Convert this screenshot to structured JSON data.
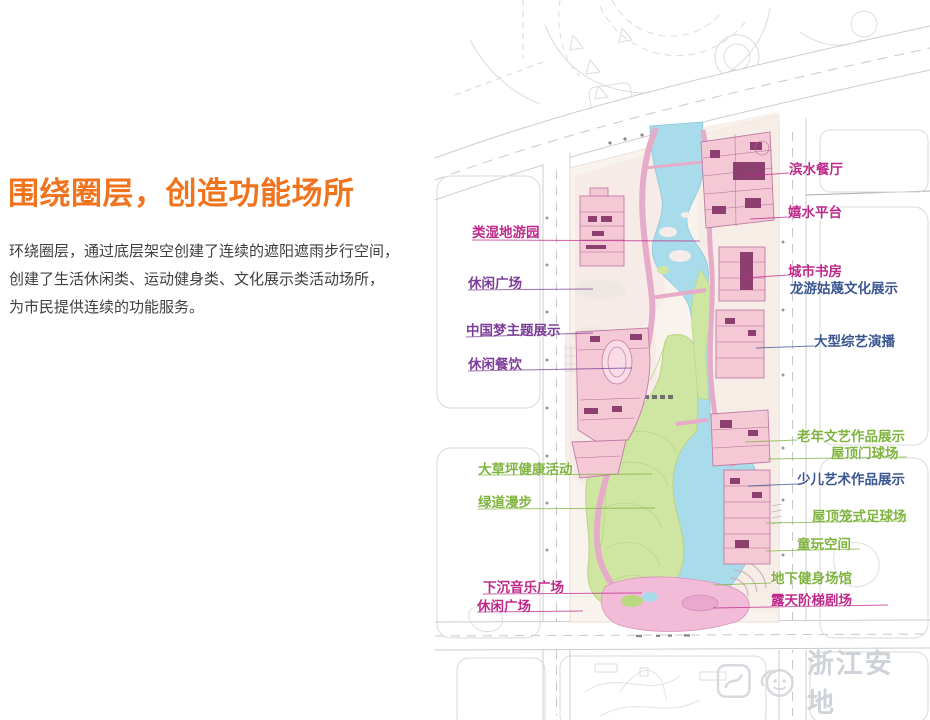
{
  "slide": {
    "title": "围绕圈层，创造功能场所",
    "body_lines": [
      "环绕圈层，通过底层架空创建了连续的遮阳遮雨步行空间，",
      "创建了生活休闲类、运动健身类、文化展示类活动场所，",
      "为市民提供连续的功能服务。"
    ]
  },
  "palette": {
    "orange": "#f0731e",
    "magenta": "#bf2a8a",
    "purple": "#7c3e99",
    "green": "#7fb440",
    "navy": "#3a5691",
    "logo_gray": "#ccd1d8"
  },
  "map": {
    "description": "site master plan with river, lawn and building clusters",
    "labels": [
      {
        "id": "wetland-park",
        "text": "类湿地游园",
        "color": "magenta",
        "x": 472,
        "y": 221,
        "leader": [
          472,
          240,
          700,
          241
        ]
      },
      {
        "id": "leisure-plaza-west",
        "text": "休闲广场",
        "color": "purple",
        "x": 468,
        "y": 272,
        "leader": [
          468,
          290,
          593,
          289
        ]
      },
      {
        "id": "china-dream-exhibit",
        "text": "中国梦主题展示",
        "color": "purple",
        "x": 466,
        "y": 319,
        "leader": [
          466,
          337,
          593,
          333
        ]
      },
      {
        "id": "leisure-dining",
        "text": "休闲餐饮",
        "color": "purple",
        "x": 468,
        "y": 353,
        "leader": [
          468,
          371,
          632,
          368
        ]
      },
      {
        "id": "lawn-health-activity",
        "text": "大草坪健康活动",
        "color": "green",
        "x": 478,
        "y": 458,
        "leader": [
          478,
          475,
          652,
          474
        ]
      },
      {
        "id": "greenway-stroll",
        "text": "绿道漫步",
        "color": "green",
        "x": 478,
        "y": 491,
        "leader": [
          478,
          509,
          655,
          508
        ]
      },
      {
        "id": "sunken-music-plaza",
        "text": "下沉音乐广场",
        "color": "magenta",
        "x": 483,
        "y": 576,
        "leader": [
          483,
          594,
          642,
          593
        ]
      },
      {
        "id": "leisure-plaza-south",
        "text": "休闲广场",
        "color": "magenta",
        "x": 477,
        "y": 595,
        "leader": [
          477,
          612,
          583,
          611
        ]
      },
      {
        "id": "waterfront-restaurant",
        "text": "滨水餐厅",
        "color": "magenta",
        "x": 789,
        "y": 158,
        "leader": [
          746,
          176,
          789,
          173
        ]
      },
      {
        "id": "water-play-platform",
        "text": "嬉水平台",
        "color": "magenta",
        "x": 788,
        "y": 201,
        "leader": [
          750,
          219,
          788,
          217
        ]
      },
      {
        "id": "city-study",
        "text": "城市书房",
        "color": "magenta",
        "x": 788,
        "y": 260,
        "leader": [
          744,
          278,
          788,
          275
        ]
      },
      {
        "id": "longyou-gumie-culture-exhibit",
        "text": "龙游姑蔑文化展示",
        "color": "navy",
        "x": 790,
        "y": 277,
        "leader": null
      },
      {
        "id": "variety-show-studio",
        "text": "大型综艺演播",
        "color": "navy",
        "x": 814,
        "y": 330,
        "leader": [
          756,
          348,
          814,
          346
        ]
      },
      {
        "id": "senior-art-exhibit",
        "text": "老年文艺作品展示",
        "color": "green",
        "x": 797,
        "y": 425,
        "leader": [
          745,
          442,
          797,
          440
        ]
      },
      {
        "id": "rooftop-gateball-court",
        "text": "屋顶门球场",
        "color": "green",
        "x": 831,
        "y": 442,
        "leader": [
          768,
          459,
          907,
          457
        ]
      },
      {
        "id": "children-art-exhibit",
        "text": "少儿艺术作品展示",
        "color": "navy",
        "x": 797,
        "y": 468,
        "leader": [
          748,
          486,
          797,
          484
        ]
      },
      {
        "id": "rooftop-cage-football",
        "text": "屋顶笼式足球场",
        "color": "green",
        "x": 812,
        "y": 505,
        "leader": [
          766,
          523,
          907,
          521
        ]
      },
      {
        "id": "children-play-space",
        "text": "童玩空间",
        "color": "green",
        "x": 797,
        "y": 533,
        "leader": [
          766,
          551,
          860,
          549
        ]
      },
      {
        "id": "underground-gym",
        "text": "地下健身场馆",
        "color": "green",
        "x": 771,
        "y": 567,
        "leader": [
          714,
          585,
          771,
          583
        ]
      },
      {
        "id": "open-air-amphitheater",
        "text": "露天阶梯剧场",
        "color": "magenta",
        "x": 771,
        "y": 589,
        "leader": [
          713,
          608,
          888,
          605
        ]
      }
    ]
  },
  "logo": {
    "text": "浙江安地",
    "icons": [
      "rounded-square-logo-icon",
      "smiley-logo-icon"
    ]
  }
}
